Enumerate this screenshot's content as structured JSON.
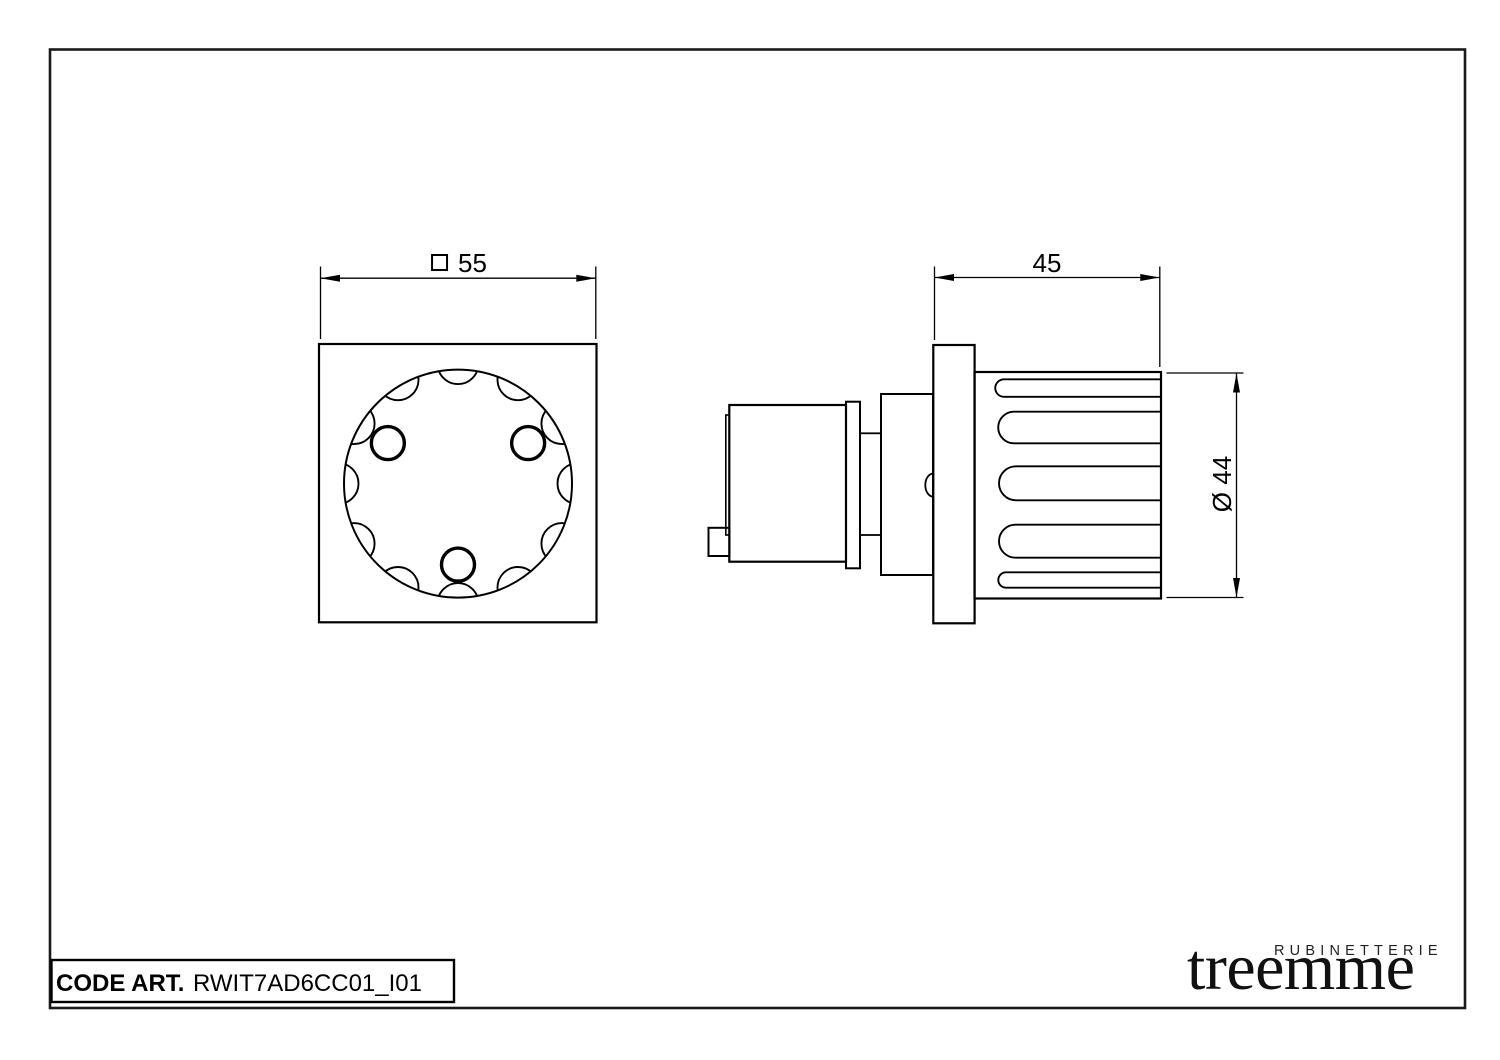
{
  "title_block": {
    "code_label": "CODE ART.",
    "code_value": "RWIT7AD6CC01_I01"
  },
  "logo": {
    "tagline": "RUBINETTERIE",
    "brand": "treemme"
  },
  "dimensions": {
    "front_square": "55",
    "side_depth": "45",
    "knob_diameter": "Ø 44"
  },
  "drawing": {
    "line_color": "#000000",
    "background": "#ffffff",
    "views": [
      "front-view-knob-plate",
      "side-view-knob-assembly"
    ]
  }
}
